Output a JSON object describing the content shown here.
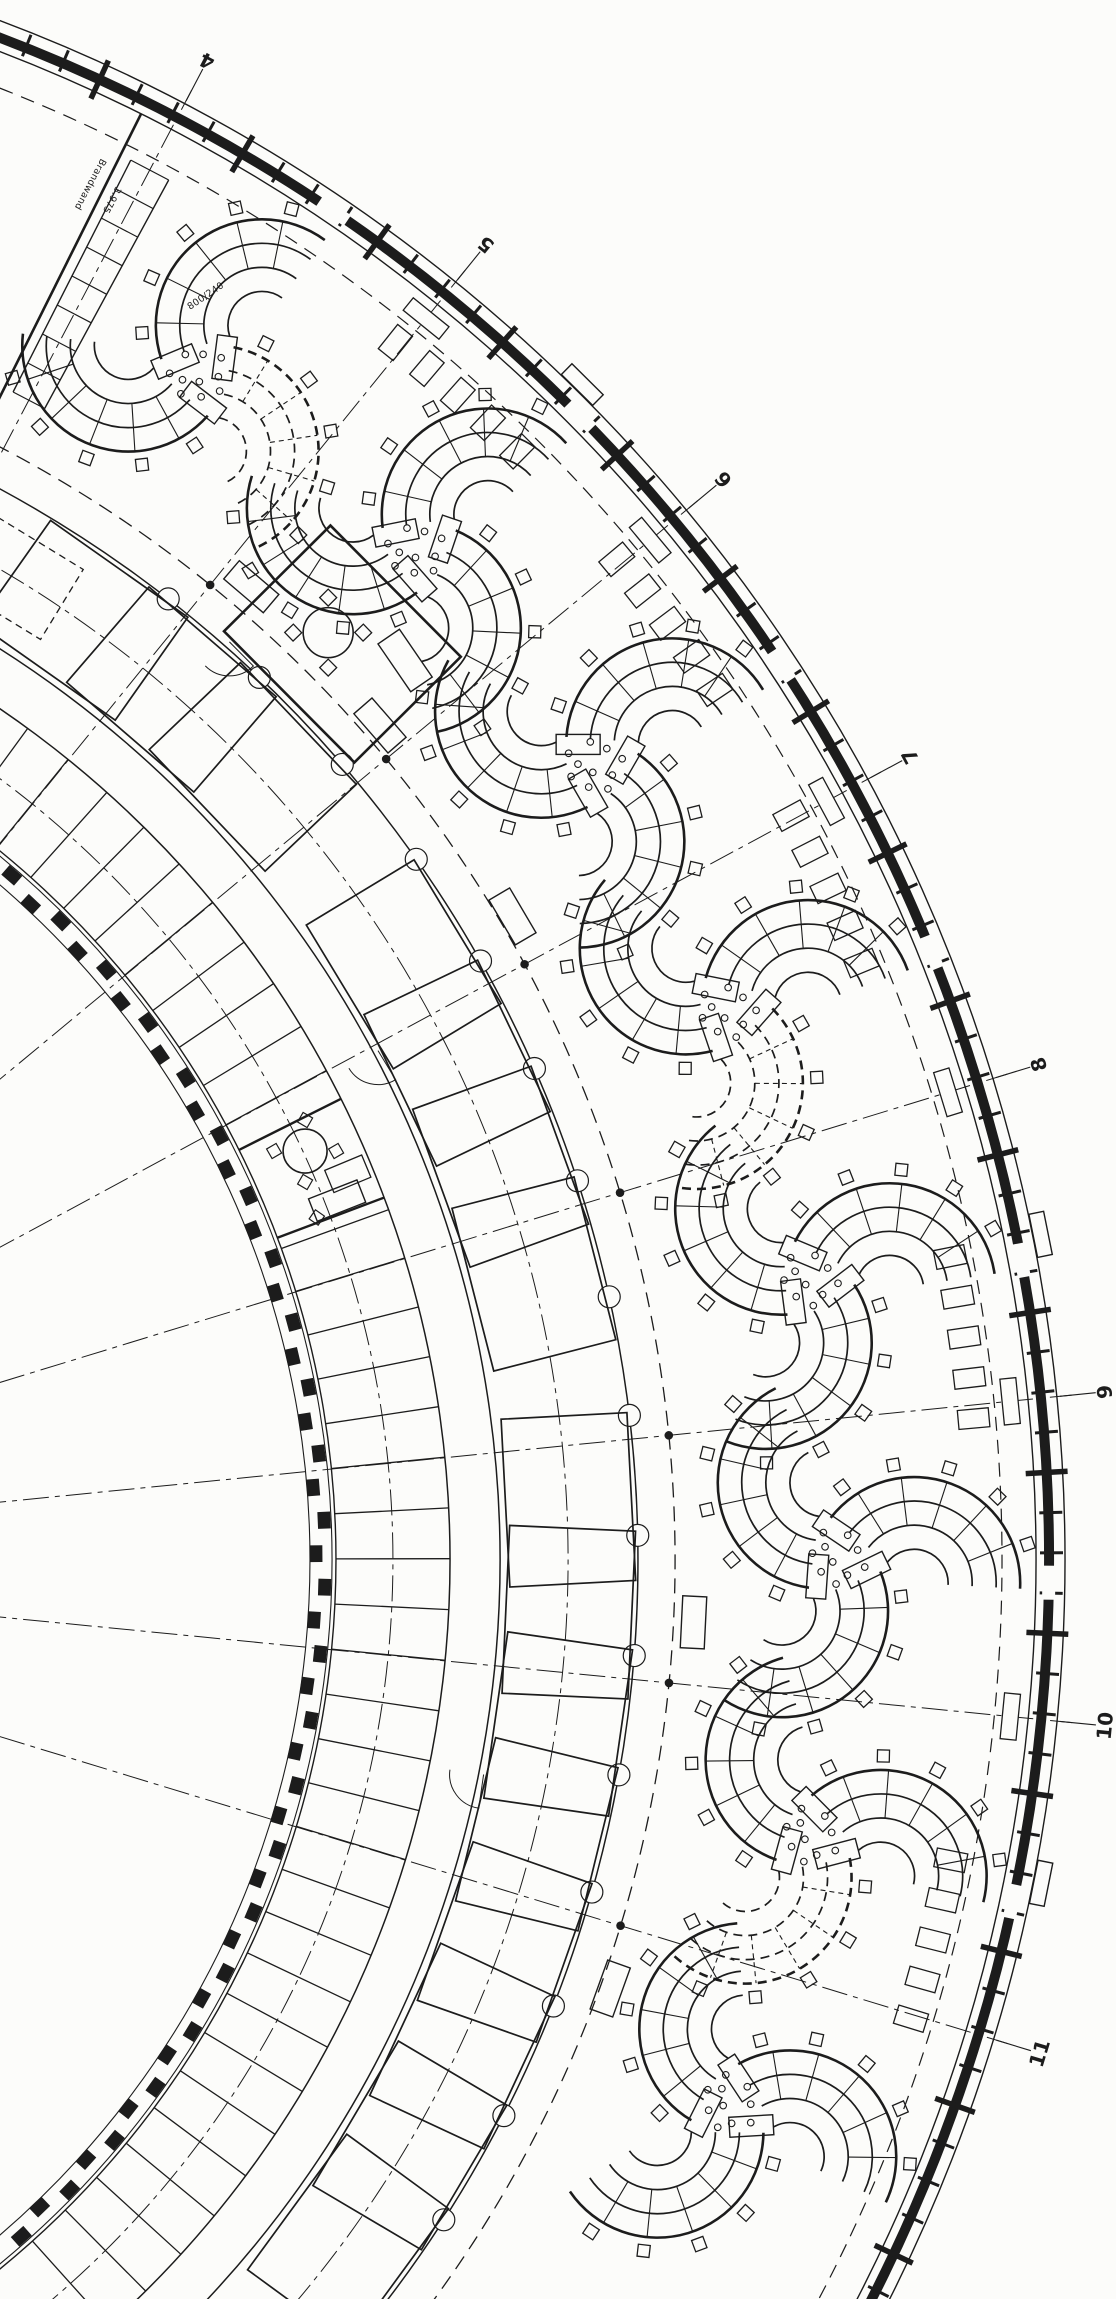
{
  "document": {
    "title": "Curved ring-wing office floor plan (scanned working drawing)",
    "type": "architectural floor plan",
    "paper_color": "#fcfcfa",
    "ink_color": "#1c1c1c"
  },
  "grid": {
    "marker_labels": [
      "4",
      "5",
      "6",
      "7",
      "8",
      "9",
      "10",
      "11"
    ],
    "angles_deg": [
      -62.3,
      -50.98,
      -39.66,
      -28.34,
      -17.02,
      -5.7,
      5.62,
      16.94
    ],
    "marker_radius": 1700,
    "leader_r1": 1648,
    "leader_r2": 1684,
    "line_r1": 520,
    "line_r2": 1660,
    "dashdot": "26 6 5 6"
  },
  "plan": {
    "center_x": -580,
    "center_y": 1560,
    "arcs": [
      {
        "name": "outer-facade-outer-line",
        "r": 1645,
        "a1": -73,
        "a2": 30,
        "w": 1.4
      },
      {
        "name": "outer-facade-glazing-band",
        "r": 1629,
        "a1": -73,
        "a2": 30,
        "w": 10
      },
      {
        "name": "outer-facade-inner-line",
        "r": 1616,
        "a1": -73,
        "a2": 30,
        "w": 1.4
      },
      {
        "name": "facade-setback-dashed-line",
        "r": 1582,
        "a1": -71,
        "a2": 28.5,
        "w": 1.2,
        "dash": "14 9"
      },
      {
        "name": "open-zone-boundary-dashed",
        "r": 1255,
        "a1": -66,
        "a2": 38,
        "w": 1.3,
        "dash": "15 9"
      },
      {
        "name": "mid-band-outer-wall",
        "r": 1218,
        "a1": -66,
        "a2": 40,
        "w": 1.5
      },
      {
        "name": "mid-band-axis-dashdot",
        "r": 1148,
        "a1": -66,
        "a2": 45,
        "w": 1,
        "dash": "26 6 5 6"
      },
      {
        "name": "mid-band-inner-wall",
        "r": 1080,
        "a1": -68,
        "a2": 52,
        "w": 1.5
      },
      {
        "name": "corridor-inner-wall",
        "r": 1030,
        "a1": -68,
        "a2": 52,
        "w": 1.5
      },
      {
        "name": "cell-band-axis-dashdot",
        "r": 973,
        "a1": -70,
        "a2": 52,
        "w": 1,
        "dash": "26 6 5 6"
      },
      {
        "name": "cell-band-inner-wall",
        "r": 916,
        "a1": -71,
        "a2": 52,
        "w": 1.4
      },
      {
        "name": "inner-facade-outer-line",
        "r": 912,
        "a1": -71,
        "a2": 52,
        "w": 1.1
      },
      {
        "name": "inner-facade-inner-line",
        "r": 890,
        "a1": -71,
        "a2": 52,
        "w": 1.1
      }
    ],
    "mullions": {
      "step_deg": 1.415,
      "a1": -71,
      "a2": 29,
      "r1": 1620,
      "r2": 1643,
      "pier_r1": 1608,
      "pier_r2": 1650
    },
    "facade_boxes_angles": [
      -50.98,
      -39.66,
      -28.34,
      -17.02,
      -5.7,
      5.62
    ],
    "facade_patches_angles": [
      -55.9,
      -44.6,
      -33.3,
      -21.9,
      -10.6,
      0.8,
      12.1
    ],
    "entrance_angles": [
      -45.32,
      -11.36,
      11.28
    ],
    "inner_facade_blocks": {
      "step_deg": 2.12,
      "a1": -64,
      "a2": 50,
      "r": 900,
      "w": 16,
      "d": 12
    },
    "cell_partitions": {
      "step_deg": 2.83,
      "a1": -59.5,
      "a2": 49.5,
      "r1": 916,
      "r2": 1030
    },
    "corridor_tabs": {
      "step_deg": 5.66,
      "a1": -52.1,
      "a2": 36,
      "r": 1218
    },
    "mid_rooms": {
      "angles_deg": [
        -54.8,
        -49.2,
        -43.6,
        -31.2,
        -25.6,
        -20,
        -14.4,
        -3,
        2.6,
        8.2,
        13.8,
        19.4,
        25,
        30.6,
        36.2
      ],
      "r": 1150,
      "len": 168,
      "depth": 126
    },
    "clusters": {
      "r": 1420,
      "angles_deg": [
        -56.64,
        -45.32,
        -34,
        -22.68,
        -11.36,
        -0.04,
        11.28,
        22.6
      ],
      "dashed_idx": [
        0,
        3,
        6
      ],
      "swirl_deg": 18
    },
    "cluster_dots": [
      [
        0,
        -26
      ],
      [
        13,
        -12
      ],
      [
        -14,
        -14
      ],
      [
        25,
        -4
      ],
      [
        -25,
        0
      ],
      [
        5,
        6
      ],
      [
        -7,
        18
      ],
      [
        18,
        14
      ],
      [
        -20,
        24
      ],
      [
        3,
        28
      ]
    ],
    "banana_rows_angles": [
      -48.3,
      -36.9,
      -25.5,
      -8.2,
      14.1
    ],
    "loose_desks": [
      {
        "a": -49.5,
        "r": 1280
      },
      {
        "a": -41,
        "r": 1272
      },
      {
        "a": -30.5,
        "r": 1268
      },
      {
        "a": 2.8,
        "r": 1275
      },
      {
        "a": 19.8,
        "r": 1265
      }
    ],
    "column_dots_r": 1255,
    "stair": {
      "angle_deg": -62.3,
      "r1": 1310,
      "r2": 1570,
      "steps": 9,
      "half_w_deg": 0.78,
      "wall_angle_deg": -63.5
    }
  },
  "rooms": [
    {
      "name": "meeting-room",
      "a": -44.8,
      "r": 1300,
      "w": 185,
      "d": 150,
      "table_r": 25
    },
    {
      "name": "team-office",
      "a": -23.6,
      "wall_a1": -26.6,
      "wall_a2": -20.6,
      "table_r": 22
    }
  ],
  "annotations": [
    {
      "text": "Brandwand"
    },
    {
      "text": "3.975"
    },
    {
      "text": "800/240"
    }
  ]
}
